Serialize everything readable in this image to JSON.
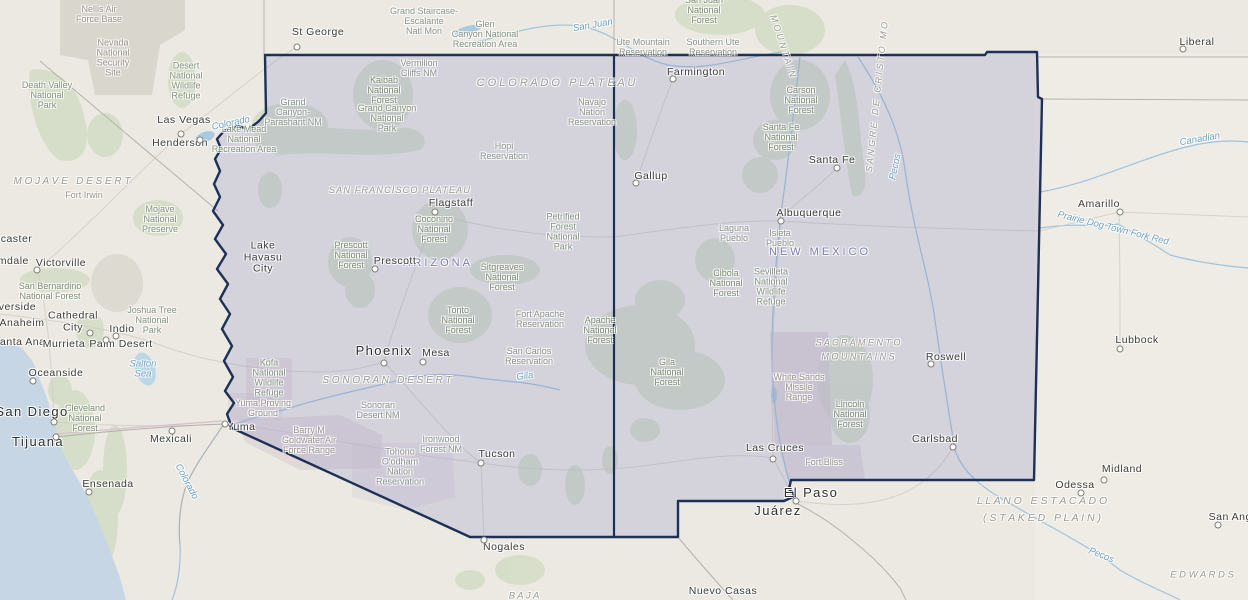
{
  "map": {
    "colors": {
      "highlight_fill": "#d9d6ec",
      "highlight_border": "#1d3055",
      "ocean": "#c7d6e4",
      "forest_patch": "#c9d8ba",
      "river": "#9fc3dd",
      "military_patch": "#d5cbce",
      "state_label": "#7b7bb4",
      "water_label": "#6ea3c2"
    },
    "states": [
      {
        "n": "ARIZONA",
        "x": 438,
        "y": 263
      },
      {
        "n": "NEW MEXICO",
        "x": 820,
        "y": 252
      }
    ],
    "regions": [
      {
        "n": "M O J A V E   D E S E R T",
        "x": 72,
        "y": 182,
        "fs": 10
      },
      {
        "n": "C O L O R A D O   P L A T E A U",
        "x": 556,
        "y": 84,
        "fs": 11
      },
      {
        "n": "SAN FRANCISCO PLATEAU",
        "x": 400,
        "y": 190,
        "fs": 9,
        "ls": 1.2
      },
      {
        "n": "S O N O R A N   D E S E R T",
        "x": 387,
        "y": 381,
        "fs": 10
      },
      {
        "n": "S A C R A M E N T O\nM O U N T A I N S",
        "x": 858,
        "y": 350,
        "fs": 9
      },
      {
        "n": "L L A N O   E S T A C A D O\n( S T A K E D   P L A I N )",
        "x": 1042,
        "y": 510,
        "fs": 10.5
      },
      {
        "n": "E D W A R D S",
        "x": 1202,
        "y": 575,
        "fs": 9.5
      },
      {
        "n": "B A J A",
        "x": 524,
        "y": 596,
        "fs": 9.5
      },
      {
        "n": "M O U N T A I N",
        "x": 783,
        "y": 46,
        "fs": 9,
        "rot": 72
      },
      {
        "n": "S A N G R E   D E   C R I S T O   M O",
        "x": 877,
        "y": 97,
        "fs": 9,
        "rot": -84
      }
    ],
    "waters": [
      {
        "n": "San Juan",
        "x": 593,
        "y": 26,
        "rot": -10
      },
      {
        "n": "Colorado",
        "x": 231,
        "y": 124,
        "rot": -12
      },
      {
        "n": "Colorado",
        "x": 186,
        "y": 482,
        "rot": 62
      },
      {
        "n": "Gila",
        "x": 525,
        "y": 377,
        "rot": -8
      },
      {
        "n": "Salton\nSea",
        "x": 143,
        "y": 370
      },
      {
        "n": "Pecos",
        "x": 896,
        "y": 167,
        "rot": -78
      },
      {
        "n": "Pecos",
        "x": 1101,
        "y": 556,
        "rot": 22
      },
      {
        "n": "Canadian",
        "x": 1200,
        "y": 140,
        "rot": -10
      },
      {
        "n": "Prairie Dog Town Fork Red",
        "x": 1113,
        "y": 229,
        "rot": 14
      }
    ],
    "cities": [
      {
        "n": "St George",
        "x": 318,
        "y": 33,
        "m": [
          297,
          47
        ]
      },
      {
        "n": "Las Vegas",
        "x": 184,
        "y": 121,
        "m": [
          181,
          134
        ]
      },
      {
        "n": "Henderson",
        "x": 180,
        "y": 144,
        "m": [
          200,
          140
        ]
      },
      {
        "n": "Lancaster",
        "x": 7,
        "y": 240
      },
      {
        "n": "Palmdale",
        "x": 5,
        "y": 262
      },
      {
        "n": "Victorville",
        "x": 61,
        "y": 264,
        "m": [
          37,
          270
        ]
      },
      {
        "n": "Riverside",
        "x": 12,
        "y": 308
      },
      {
        "n": "Anaheim",
        "x": 22,
        "y": 324
      },
      {
        "n": "Santa Ana",
        "x": 19,
        "y": 343
      },
      {
        "n": "Murrieta",
        "x": 64,
        "y": 345
      },
      {
        "n": "Cathedral\nCity",
        "x": 73,
        "y": 322,
        "m": [
          90,
          333
        ]
      },
      {
        "n": "Indio",
        "x": 122,
        "y": 330,
        "m": [
          116,
          336
        ]
      },
      {
        "n": "Palm Desert",
        "x": 121,
        "y": 345,
        "m": [
          106,
          340
        ]
      },
      {
        "n": "Oceanside",
        "x": 56,
        "y": 374,
        "m": [
          33,
          381
        ]
      },
      {
        "n": "San Diego",
        "x": 32,
        "y": 412,
        "s": 2,
        "m": [
          54,
          422
        ]
      },
      {
        "n": "Tijuana",
        "x": 38,
        "y": 442,
        "s": 2,
        "m": [
          56,
          437
        ]
      },
      {
        "n": "Mexicali",
        "x": 171,
        "y": 440,
        "m": [
          172,
          431
        ]
      },
      {
        "n": "Ensenada",
        "x": 108,
        "y": 485,
        "m": [
          89,
          492
        ]
      },
      {
        "n": "Lake\nHavasu\nCity",
        "x": 263,
        "y": 258
      },
      {
        "n": "Phoenix",
        "x": 384,
        "y": 351,
        "s": 2,
        "m": [
          384,
          363
        ]
      },
      {
        "n": "Mesa",
        "x": 436,
        "y": 354,
        "m": [
          423,
          362
        ]
      },
      {
        "n": "Flagstaff",
        "x": 451,
        "y": 204,
        "m": [
          435,
          212
        ]
      },
      {
        "n": "Prescott",
        "x": 395,
        "y": 262,
        "m": [
          375,
          269
        ]
      },
      {
        "n": "Yuma",
        "x": 241,
        "y": 428,
        "m": [
          225,
          424
        ]
      },
      {
        "n": "Tucson",
        "x": 497,
        "y": 455,
        "m": [
          481,
          463
        ]
      },
      {
        "n": "Nogales",
        "x": 504,
        "y": 548,
        "m": [
          484,
          540
        ]
      },
      {
        "n": "Gallup",
        "x": 651,
        "y": 177,
        "m": [
          636,
          183
        ]
      },
      {
        "n": "Farmington",
        "x": 696,
        "y": 73,
        "m": [
          673,
          79
        ]
      },
      {
        "n": "Albuquerque",
        "x": 809,
        "y": 214,
        "m": [
          781,
          221
        ]
      },
      {
        "n": "Santa Fe",
        "x": 832,
        "y": 161,
        "m": [
          837,
          168
        ]
      },
      {
        "n": "Roswell",
        "x": 946,
        "y": 358,
        "m": [
          931,
          364
        ]
      },
      {
        "n": "Carlsbad",
        "x": 935,
        "y": 440,
        "m": [
          953,
          447
        ]
      },
      {
        "n": "Las Cruces",
        "x": 775,
        "y": 449,
        "m": [
          773,
          459
        ]
      },
      {
        "n": "El Paso",
        "x": 811,
        "y": 493,
        "s": 2,
        "m": [
          796,
          501
        ]
      },
      {
        "n": "Juárez",
        "x": 778,
        "y": 511,
        "s": 2
      },
      {
        "n": "Liberal",
        "x": 1197,
        "y": 43,
        "m": [
          1183,
          49
        ]
      },
      {
        "n": "Amarillo",
        "x": 1099,
        "y": 205,
        "m": [
          1120,
          212
        ]
      },
      {
        "n": "Lubbock",
        "x": 1137,
        "y": 341,
        "m": [
          1120,
          349
        ]
      },
      {
        "n": "Midland",
        "x": 1122,
        "y": 470,
        "m": [
          1104,
          480
        ]
      },
      {
        "n": "Odessa",
        "x": 1075,
        "y": 486,
        "m": [
          1081,
          493
        ]
      },
      {
        "n": "San Angelo",
        "x": 1238,
        "y": 518,
        "m": [
          1218,
          525
        ]
      },
      {
        "n": "Nuevo Casas",
        "x": 723,
        "y": 592
      }
    ],
    "areas": [
      {
        "n": "Nellis Air\nForce Base",
        "x": 99,
        "y": 14,
        "k": "m"
      },
      {
        "n": "Nevada\nNational\nSecurity\nSite",
        "x": 113,
        "y": 58,
        "k": "m"
      },
      {
        "n": "Desert\nNational\nWildlife\nRefuge",
        "x": 186,
        "y": 81,
        "k": "p"
      },
      {
        "n": "Death Valley\nNational\nPark",
        "x": 47,
        "y": 95,
        "k": "p"
      },
      {
        "n": "Mojave\nNational\nPreserve",
        "x": 160,
        "y": 219,
        "k": "p"
      },
      {
        "n": "Fort Irwin",
        "x": 84,
        "y": 195,
        "k": "m"
      },
      {
        "n": "San Bernardino\nNational Forest",
        "x": 50,
        "y": 291,
        "k": "f"
      },
      {
        "n": "Joshua Tree\nNational\nPark",
        "x": 152,
        "y": 320,
        "k": "p"
      },
      {
        "n": "Cleveland\nNational\nForest",
        "x": 85,
        "y": 418,
        "k": "f"
      },
      {
        "n": "Grand Staircase-\nEscalante\nNatl Mon",
        "x": 424,
        "y": 21,
        "k": "n"
      },
      {
        "n": "Glen\nCanyon National\nRecreation Area",
        "x": 485,
        "y": 34,
        "k": "p"
      },
      {
        "n": "Vermilion\nCliffs NM",
        "x": 419,
        "y": 68,
        "k": "n"
      },
      {
        "n": "Kaibab\nNational\nForest",
        "x": 384,
        "y": 90,
        "k": "f"
      },
      {
        "n": "Grand Canyon\nNational\nPark",
        "x": 387,
        "y": 118,
        "k": "p"
      },
      {
        "n": "Grand\nCanyon-\nParashant NM",
        "x": 293,
        "y": 112,
        "k": "n"
      },
      {
        "n": "Lake Mead\nNational\nRecreation Area",
        "x": 244,
        "y": 139,
        "k": "p"
      },
      {
        "n": "San Juan\nNational\nForest",
        "x": 704,
        "y": 10,
        "k": "f"
      },
      {
        "n": "Ute Mountain\nReservation",
        "x": 643,
        "y": 47,
        "k": "r"
      },
      {
        "n": "Southern Ute\nReservation",
        "x": 713,
        "y": 47,
        "k": "r"
      },
      {
        "n": "Carson\nNational\nForest",
        "x": 801,
        "y": 100,
        "k": "f"
      },
      {
        "n": "Santa Fe\nNational\nForest",
        "x": 781,
        "y": 137,
        "k": "f"
      },
      {
        "n": "Hopi\nReservation",
        "x": 504,
        "y": 151,
        "k": "r"
      },
      {
        "n": "Navajo\nNation\nReservation",
        "x": 592,
        "y": 112,
        "k": "r"
      },
      {
        "n": "Coconino\nNational\nForest",
        "x": 434,
        "y": 229,
        "k": "f"
      },
      {
        "n": "Petrified\nForest\nNational\nPark",
        "x": 563,
        "y": 232,
        "k": "p"
      },
      {
        "n": "Prescott\nNational\nForest",
        "x": 351,
        "y": 255,
        "k": "f"
      },
      {
        "n": "Sitgreaves\nNational\nForest",
        "x": 502,
        "y": 277,
        "k": "f"
      },
      {
        "n": "Tonto\nNational\nForest",
        "x": 458,
        "y": 320,
        "k": "f"
      },
      {
        "n": "Fort Apache\nReservation",
        "x": 540,
        "y": 319,
        "k": "r"
      },
      {
        "n": "Apache\nNational\nForest",
        "x": 600,
        "y": 330,
        "k": "f"
      },
      {
        "n": "San Carlos\nReservation",
        "x": 529,
        "y": 356,
        "k": "r"
      },
      {
        "n": "Gila\nNational\nForest",
        "x": 667,
        "y": 372,
        "k": "f"
      },
      {
        "n": "Kofa\nNational\nWildlife\nRefuge",
        "x": 269,
        "y": 378,
        "k": "p"
      },
      {
        "n": "Yuma Proving\nGround",
        "x": 263,
        "y": 408,
        "k": "m"
      },
      {
        "n": "Barry M\nGoldwater Air\nForce Range",
        "x": 309,
        "y": 440,
        "k": "m"
      },
      {
        "n": "Sonoran\nDesert NM",
        "x": 378,
        "y": 410,
        "k": "n"
      },
      {
        "n": "Ironwood\nForest NM",
        "x": 441,
        "y": 444,
        "k": "n"
      },
      {
        "n": "Tohono\nO'odham\nNation\nReservation",
        "x": 400,
        "y": 467,
        "k": "r"
      },
      {
        "n": "Laguna\nPueblo",
        "x": 734,
        "y": 233,
        "k": "r"
      },
      {
        "n": "Isleta\nPueblo",
        "x": 780,
        "y": 238,
        "k": "r"
      },
      {
        "n": "Cibola\nNational\nForest",
        "x": 726,
        "y": 283,
        "k": "f"
      },
      {
        "n": "Sevilleta\nNational\nWildlife\nRefuge",
        "x": 771,
        "y": 287,
        "k": "p"
      },
      {
        "n": "White Sands\nMissile\nRange",
        "x": 799,
        "y": 387,
        "k": "m"
      },
      {
        "n": "Lincoln\nNational\nForest",
        "x": 850,
        "y": 414,
        "k": "f"
      },
      {
        "n": "Fort Bliss",
        "x": 824,
        "y": 462,
        "k": "m"
      }
    ]
  }
}
